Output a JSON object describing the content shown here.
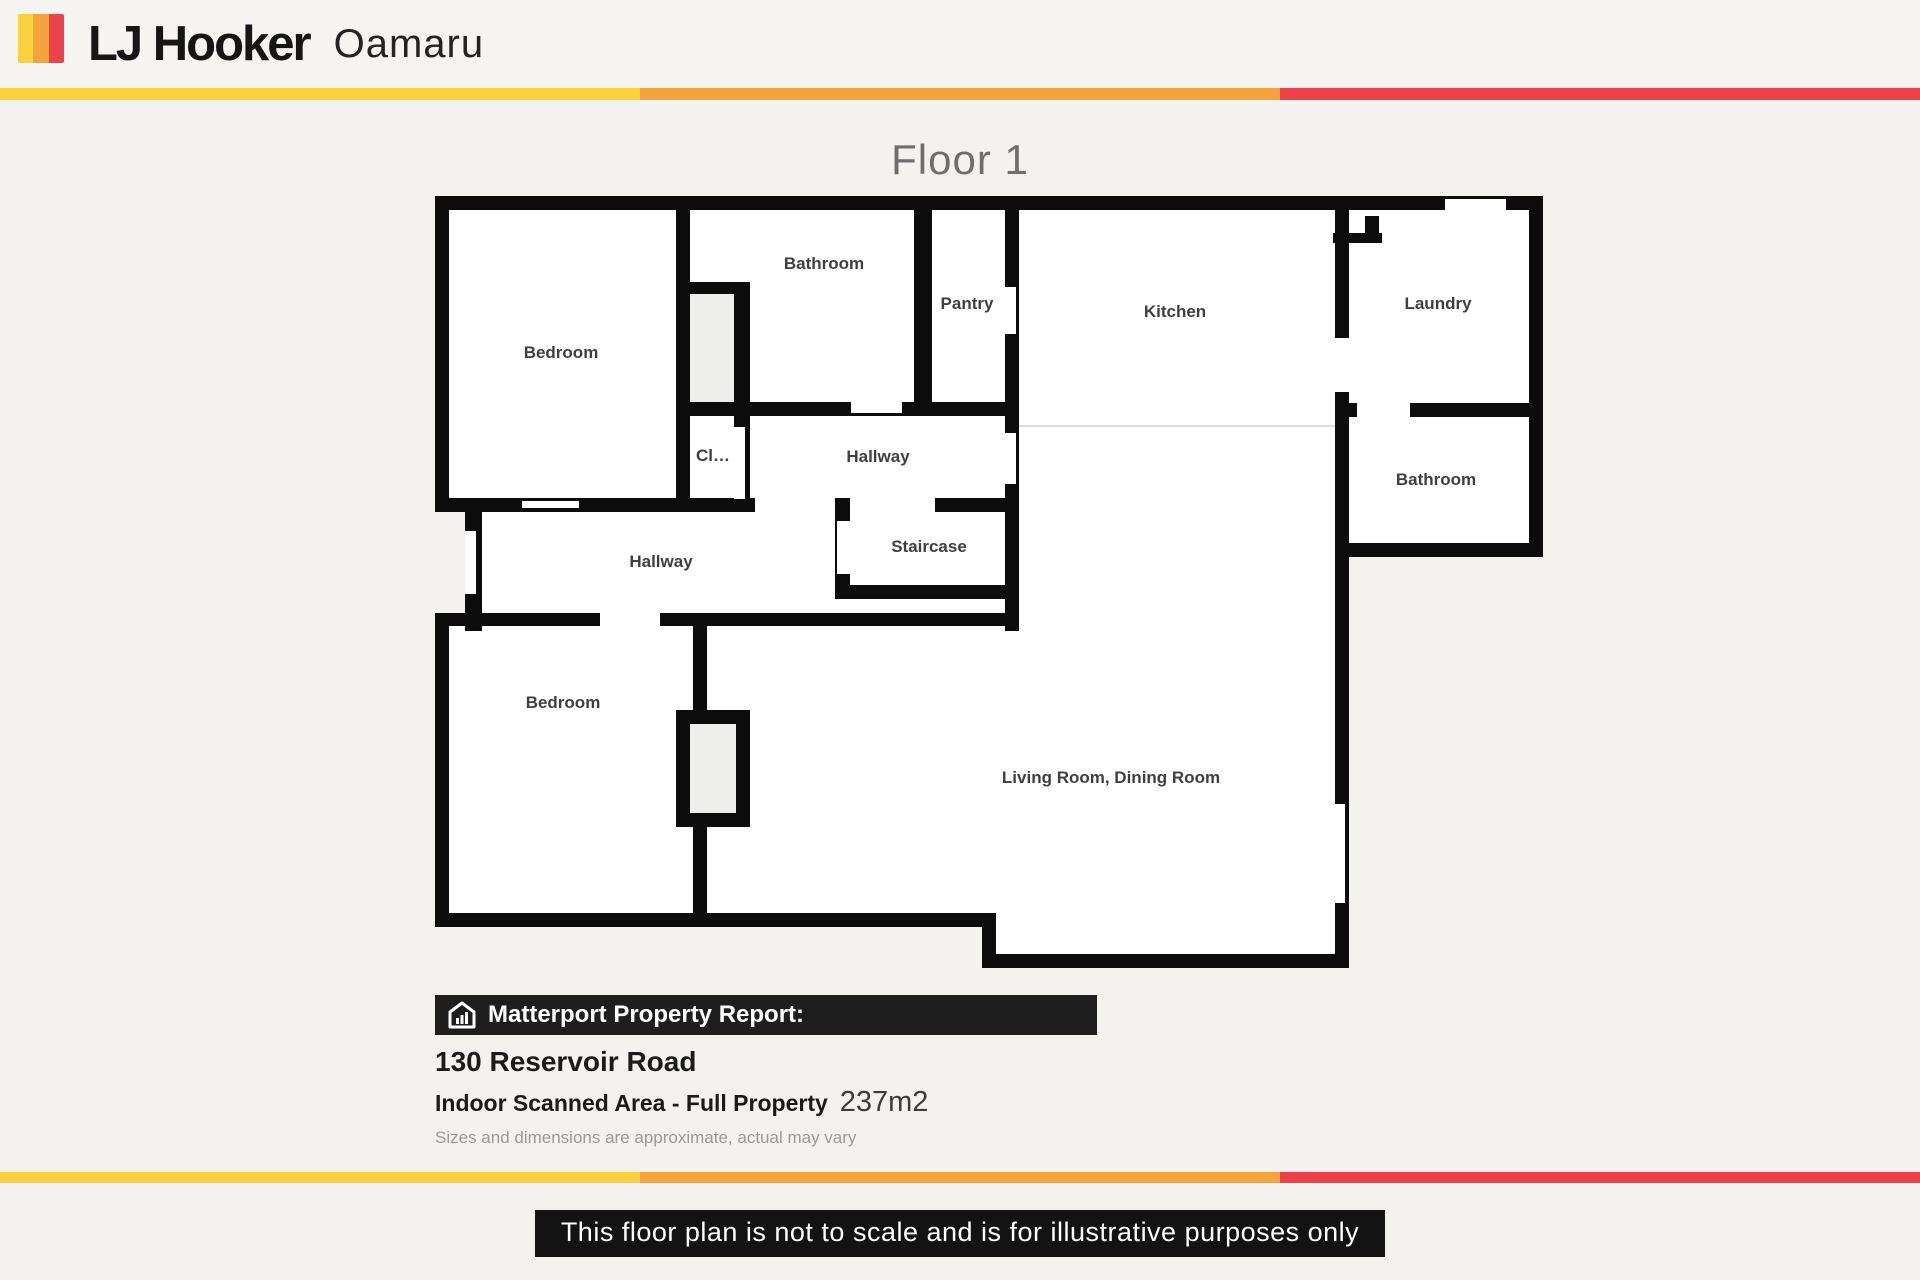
{
  "header": {
    "brand": "LJ Hooker",
    "office": "Oamaru"
  },
  "floor_title": "Floor 1",
  "rooms": {
    "bedroom_top": "Bedroom",
    "bathroom_top": "Bathroom",
    "pantry": "Pantry",
    "kitchen": "Kitchen",
    "laundry": "Laundry",
    "bathroom_right": "Bathroom",
    "closet": "Cl…",
    "hallway_upper": "Hallway",
    "hallway_lower": "Hallway",
    "staircase": "Staircase",
    "bedroom_lower": "Bedroom",
    "living": "Living Room, Dining Room"
  },
  "report": {
    "bar_label": "Matterport Property Report:",
    "address": "130 Reservoir Road",
    "area_label": "Indoor Scanned Area - Full Property",
    "area_value": "237m2",
    "disclaimer": "Sizes and dimensions are approximate, actual may vary"
  },
  "footer": {
    "notice": "This floor plan is not to scale and is for illustrative purposes only"
  },
  "colors": {
    "brand_yellow": "#FCD13E",
    "brand_orange": "#F5A33C",
    "brand_red": "#EE4149",
    "wall": "#0c0c0c",
    "floor": "#ffffff",
    "closet_fill": "#eeeeec",
    "page_bg": "#f3f2ef",
    "label_text": "#3f3f3f",
    "title_text": "#6e6e6e"
  }
}
